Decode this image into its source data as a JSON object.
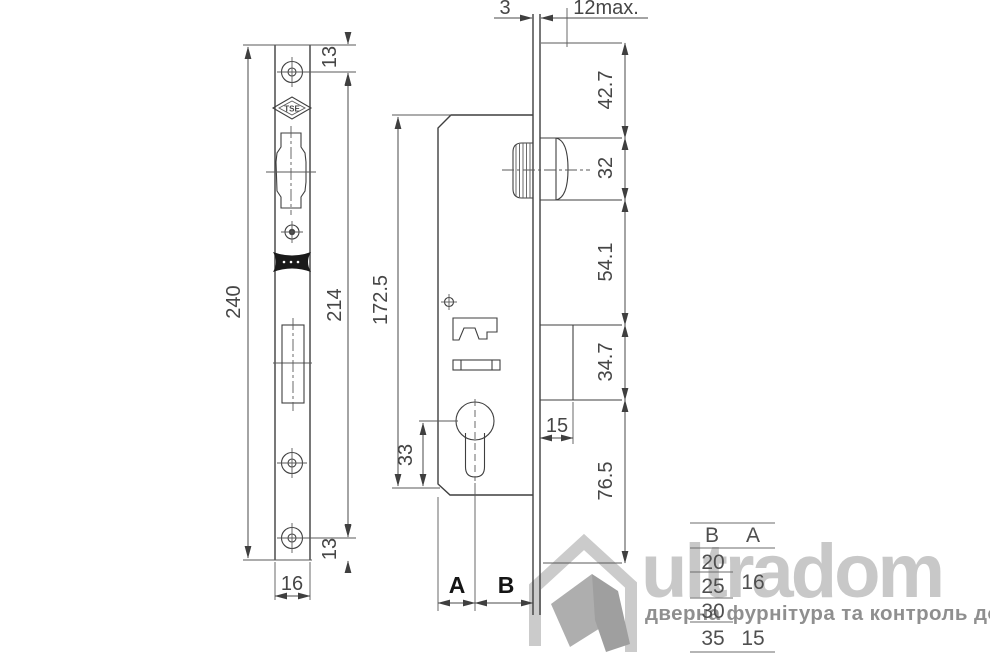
{
  "drawing": {
    "left_view": {
      "dim_overall": "240",
      "dim_hole_spacing": "214",
      "dim_top_hole_offset": "13",
      "dim_bottom_hole_offset": "13",
      "dim_plate_width": "16",
      "tse_mark": "TSE"
    },
    "main_view": {
      "dim_body_height": "172.5",
      "dim_cylinder_to_bottom": "33",
      "dim_faceplate_thickness": "3",
      "dim_max_protrusion": "12max.",
      "dim_top_to_roller": "42.7",
      "dim_roller_height": "32",
      "dim_roller_to_bolt": "54.1",
      "dim_bolt_height": "34.7",
      "dim_bolt_throw": "15",
      "dim_bolt_to_bottom": "76.5",
      "label_a": "A",
      "label_b": "B"
    },
    "size_table": {
      "col_b": "B",
      "col_a": "A",
      "b_values": [
        "20",
        "25",
        "30",
        "35"
      ],
      "a_value_top": "16",
      "a_value_bottom": "15"
    }
  },
  "watermark": {
    "brand": "ultradom",
    "tagline": "дверна фурнітура та контроль доступу"
  },
  "colors": {
    "line": "#3f3f3f",
    "dim_text": "#464646",
    "table_text": "#4f4f4f",
    "watermark_brand": "#c8c8c8",
    "watermark_tagline": "#8f8f8f",
    "label_black": "#151515"
  }
}
